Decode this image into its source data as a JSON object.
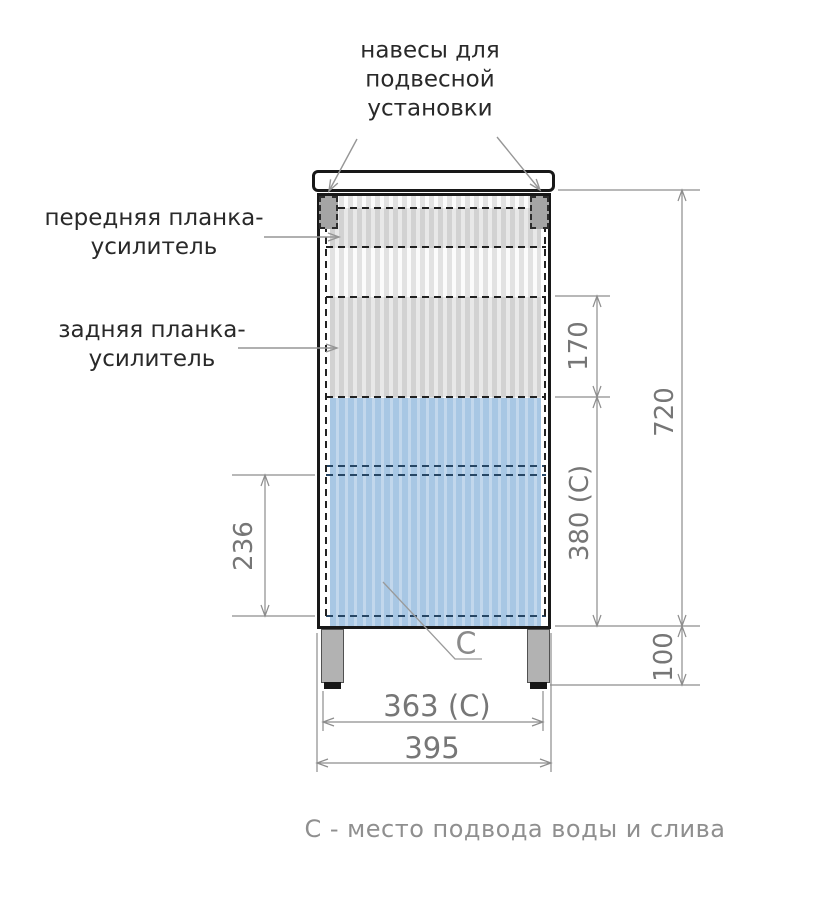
{
  "title": "Схема тумбы с размерами (вид сзади)",
  "labels": {
    "hangers": "навесы для\nподвесной\nустановки",
    "front_strip": "передняя планка-\nусилитель",
    "rear_strip": "задняя планка-\nусилитель",
    "zone_marker": "С",
    "caption": "С - место подвода воды и слива"
  },
  "dimensions": {
    "rear_strip_band_height": "170",
    "cabinet_height": "720",
    "c_zone_height": "380 (С)",
    "leg_height": "100",
    "left_band_height": "236",
    "c_zone_width": "363 (С)",
    "cabinet_width": "395"
  },
  "colors": {
    "outline": "#181818",
    "c_zone_fill": "#a8c7e4",
    "c_zone_stripe": "#c2d7ec",
    "facade_stripe": "#e2e2e2",
    "dimension_lines": "#8d8d8d",
    "dimension_text": "#767676",
    "label_text": "#292929",
    "caption_text": "#8f8f8f",
    "hinge_fill": "#a5a5a5",
    "leg_fill": "#b2b2b2"
  }
}
